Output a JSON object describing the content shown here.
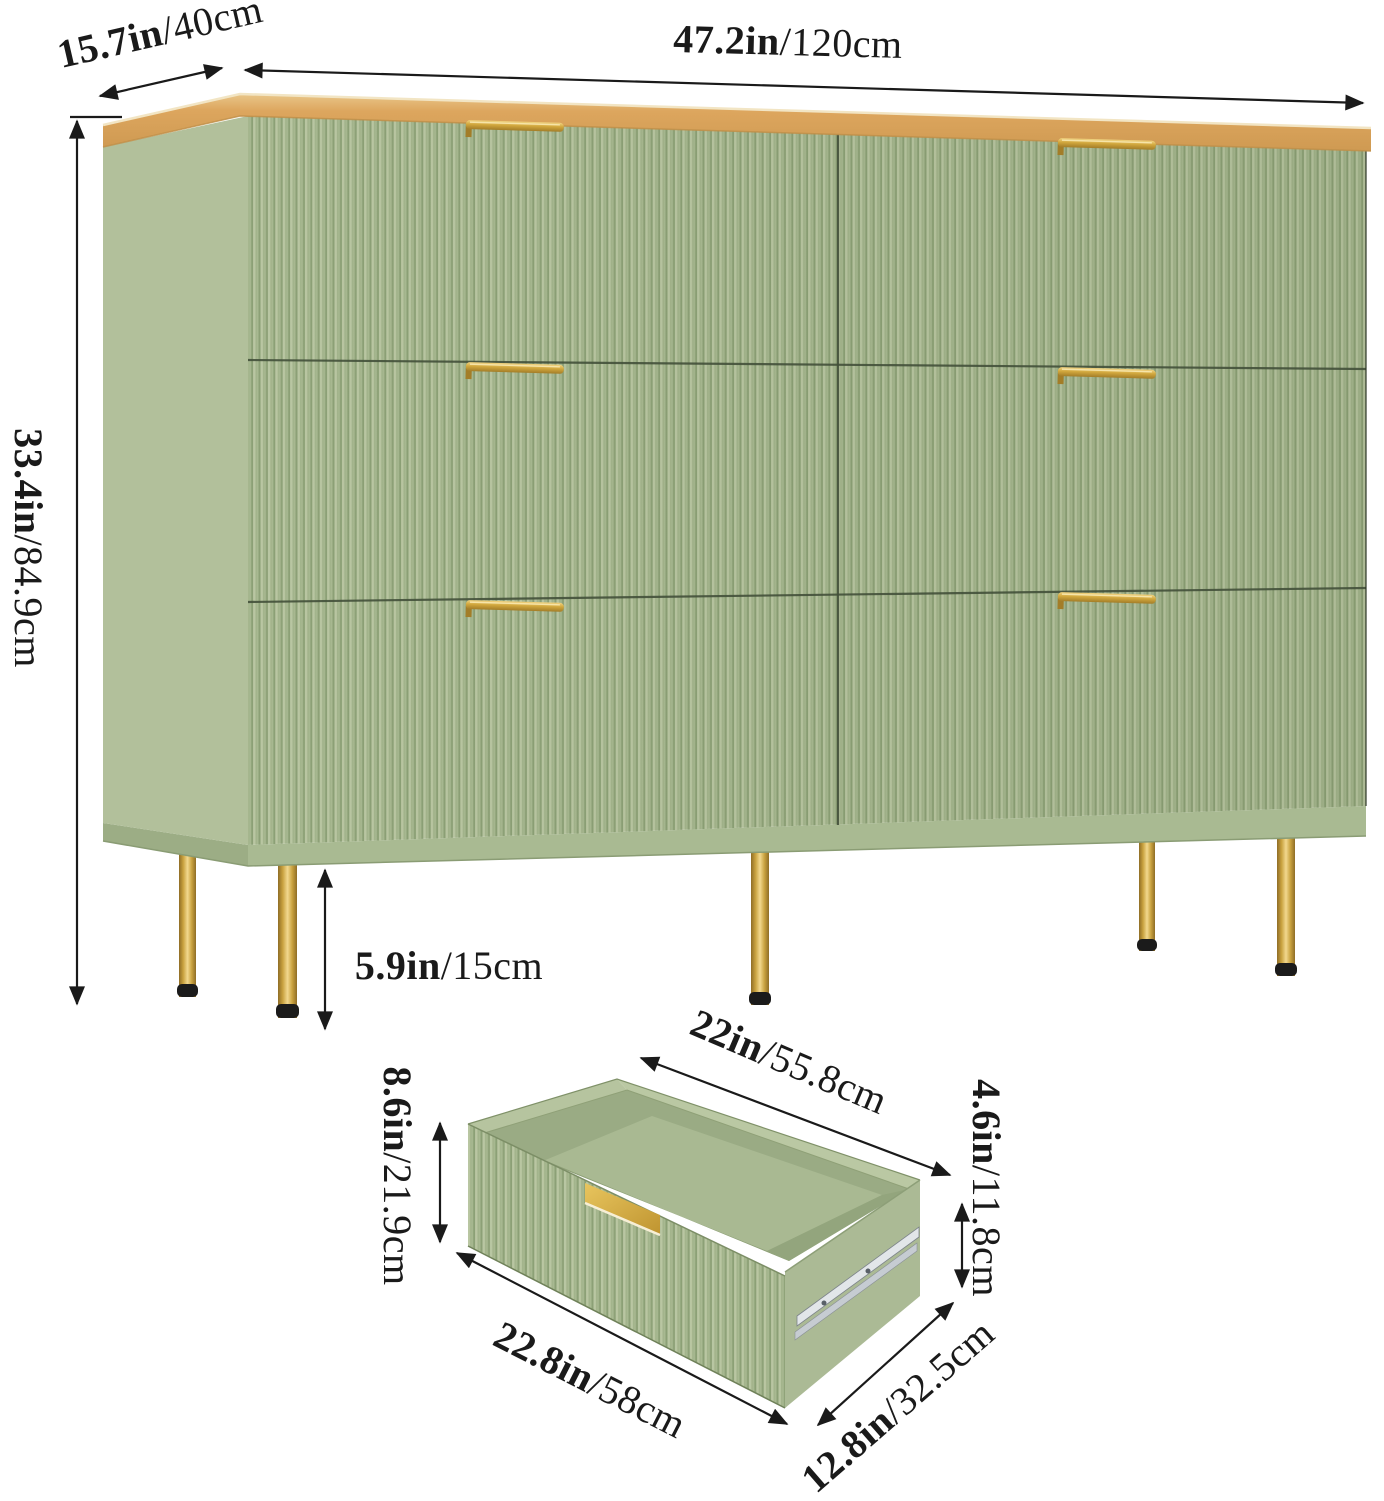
{
  "palette": {
    "ink": "#1a1a1a",
    "line": "#42503a",
    "sage": "#a9ba92",
    "sage-light": "#b9c6a2",
    "sage-mid": "#a3b48c",
    "sage-shadow": "#8ca076",
    "side": "#b2c09b",
    "underside": "#9cad85",
    "plinth": "#a9ba92",
    "wood": "#dda65e",
    "wood-dark": "#bf8f49",
    "wood-hi": "#f2e5c4",
    "gold": "#c9a23f",
    "gold-hi": "#f2d88e",
    "gold-dark": "#8f6d26",
    "cap": "#1b1b1b",
    "interior": "#9aab84",
    "floor": "#a9b992",
    "inner-shadow": "#8fa178",
    "rim": "#bac8a3",
    "rail": "#e2e6e9",
    "rail-mid": "#c6ccd2"
  },
  "dimensions": {
    "depth": {
      "in": "15.7in",
      "cm": "/40cm"
    },
    "width": {
      "in": "47.2in",
      "cm": "/120cm"
    },
    "height": {
      "in": "33.4in",
      "cm": "/84.9cm"
    },
    "leg_height": {
      "in": "5.9in",
      "cm": "/15cm"
    }
  },
  "drawer": {
    "top_width": {
      "in": "22in",
      "cm": "/55.8cm"
    },
    "front_height": {
      "in": "8.6in",
      "cm": "/21.9cm"
    },
    "inner_height": {
      "in": "4.6in",
      "cm": "/11.8cm"
    },
    "bottom_width": {
      "in": "22.8in",
      "cm": "/58cm"
    },
    "depth": {
      "in": "12.8in",
      "cm": "/32.5cm"
    }
  }
}
